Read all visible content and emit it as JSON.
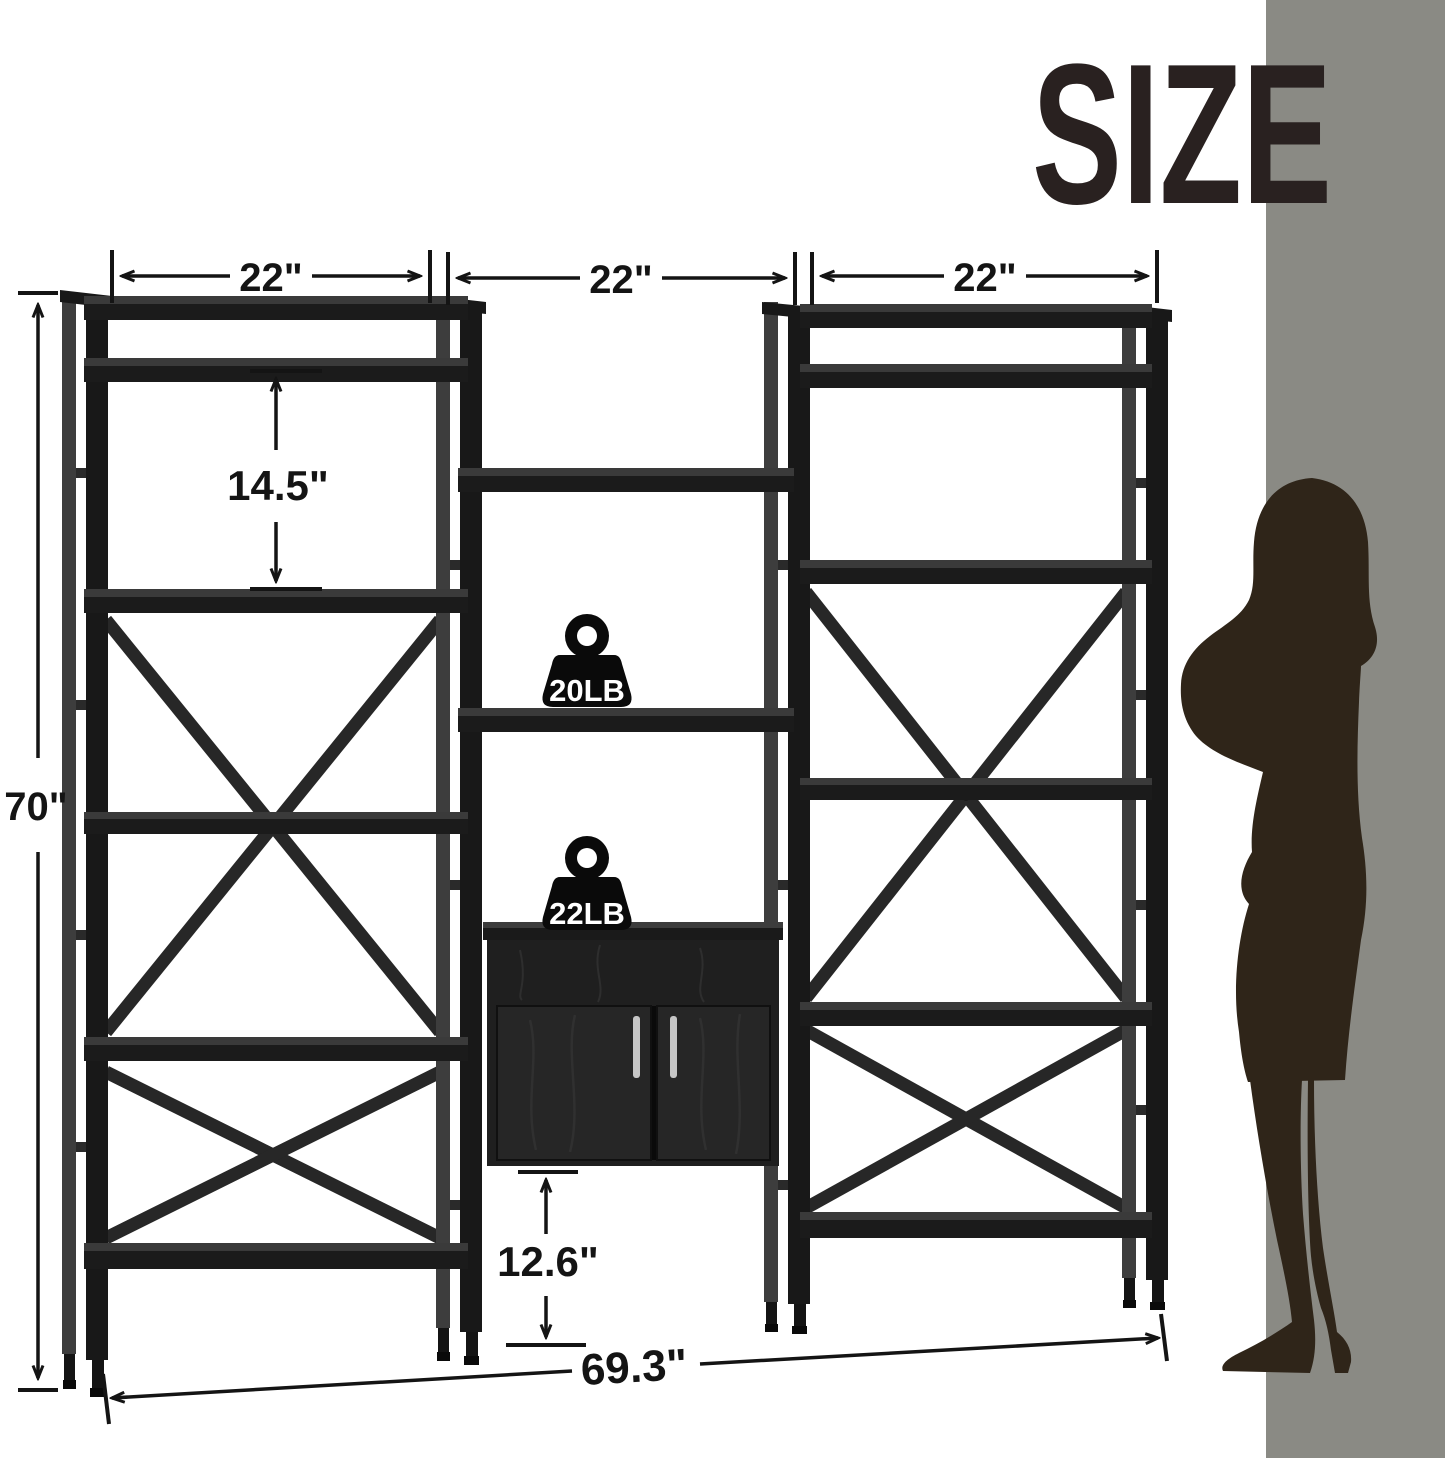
{
  "title": "SIZE",
  "unit": {
    "section_width_1": "22\"",
    "section_width_2": "22\"",
    "section_width_3": "22\"",
    "total_height": "70\"",
    "shelf_spacing": "14.5\"",
    "bottom_clearance": "12.6\"",
    "total_width": "69.3\""
  },
  "capacity": {
    "shelf_weight": "20LB",
    "cabinet_top_weight": "22LB"
  },
  "icons": {
    "weight_icon": "kettlebell-weight",
    "person_icon": "woman-silhouette"
  },
  "colors": {
    "background": "#ffffff",
    "wall": "#8a8a84",
    "frame_black": "#181818",
    "frame_highlight": "#3d3d3d",
    "title_text": "#292120",
    "dimension_ink": "#141414",
    "silhouette": "#2f2519",
    "door_handle": "#c6c6c6"
  }
}
